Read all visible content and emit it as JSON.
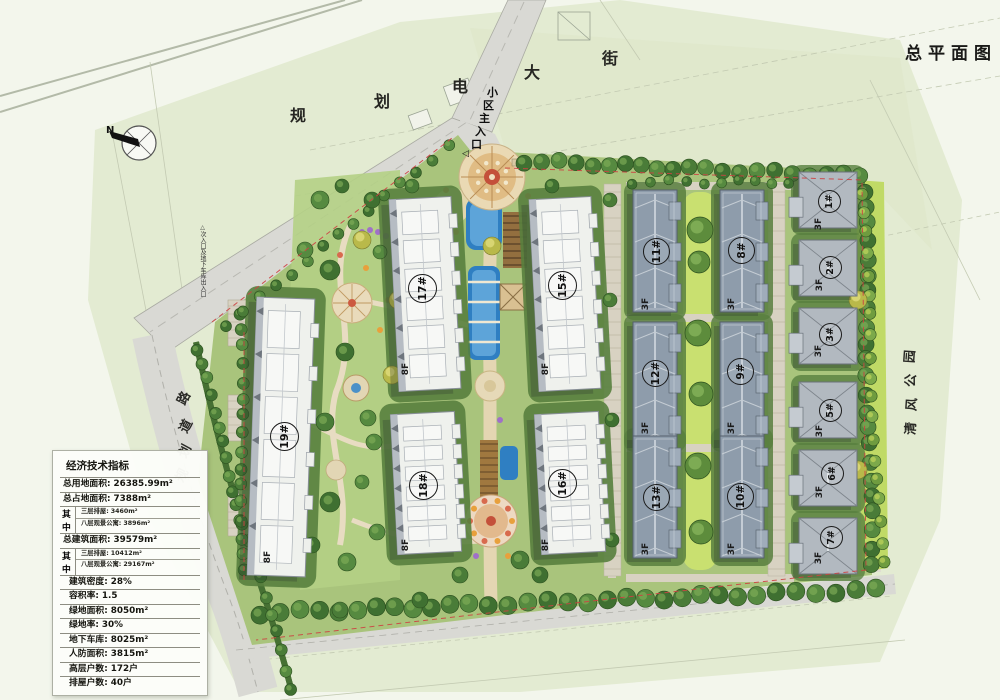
{
  "title": "总平面图",
  "north": "N",
  "streets": {
    "dianda": [
      "规",
      "划",
      "电",
      "大",
      "街"
    ],
    "west_road": [
      "路",
      "道",
      "划",
      "规"
    ],
    "park": [
      "园",
      "公",
      "风",
      "清"
    ]
  },
  "entrances": {
    "main": [
      "小",
      "区",
      "主",
      "入",
      "口"
    ],
    "main_marker": "◁",
    "secondary": "△次入口及地下车库出入口"
  },
  "buildings": {
    "highrise": [
      {
        "id": "19#",
        "floors": "8F"
      },
      {
        "id": "17#",
        "floors": "8F"
      },
      {
        "id": "18#",
        "floors": "8F"
      },
      {
        "id": "15#",
        "floors": "8F"
      },
      {
        "id": "16#",
        "floors": "8F"
      }
    ],
    "rowhouses": [
      {
        "id": "11#",
        "floors": "3F"
      },
      {
        "id": "12#",
        "floors": "3F"
      },
      {
        "id": "13#",
        "floors": "3F"
      },
      {
        "id": "8#",
        "floors": "3F"
      },
      {
        "id": "9#",
        "floors": "3F"
      },
      {
        "id": "10#",
        "floors": "3F"
      }
    ],
    "villas": [
      {
        "id": "1#",
        "floors": "3F"
      },
      {
        "id": "2#",
        "floors": "3F"
      },
      {
        "id": "3#",
        "floors": "3F"
      },
      {
        "id": "5#",
        "floors": "3F"
      },
      {
        "id": "6#",
        "floors": "3F"
      },
      {
        "id": "7#",
        "floors": "3F"
      }
    ]
  },
  "stats": {
    "title": "经济技术指标",
    "rows": [
      {
        "l": "总用地面积:",
        "v": "26385.99m²"
      },
      {
        "l": "总占地面积:",
        "v": "7388m²"
      }
    ],
    "mid1": {
      "g1": "其",
      "g2": "中",
      "sub": [
        {
          "l": "三层排屋:",
          "v": "3460m²"
        },
        {
          "l": "八层观景公寓:",
          "v": "3896m²"
        }
      ]
    },
    "row_total": {
      "l": "总建筑面积:",
      "v": "39579m²"
    },
    "mid2": {
      "g1": "其",
      "g2": "中",
      "sub": [
        {
          "l": "三层排屋:",
          "v": "10412m²"
        },
        {
          "l": "八层观景公寓:",
          "v": "29167m²"
        }
      ]
    },
    "rows2": [
      {
        "l": "建筑密度:",
        "v": "28%"
      },
      {
        "l": "容积率:",
        "v": "1.5"
      },
      {
        "l": "绿地面积:",
        "v": "8050m²"
      },
      {
        "l": "绿地率:",
        "v": "30%"
      },
      {
        "l": "地下车库:",
        "v": "8025m²"
      },
      {
        "l": "人防面积:",
        "v": "3815m²"
      },
      {
        "l": "高层户数:",
        "v": "172户"
      },
      {
        "l": "排屋户数:",
        "v": "40户"
      }
    ]
  },
  "colors": {
    "paper": "#f3f6ec",
    "field_green": "#e3ebd2",
    "site_green": "#a9c47c",
    "lawn_bright": "#c9e070",
    "road_gray": "#d9d9d4",
    "water_blue": "#2f7fc2",
    "roof_white": "#eff1ed",
    "roof_slate": "#8e9cab",
    "roof_villa": "#b2b9c0",
    "boundary_red": "#cc4343",
    "plaza_tan": "#e8d8b2",
    "tree_dark": "#3f7031"
  }
}
